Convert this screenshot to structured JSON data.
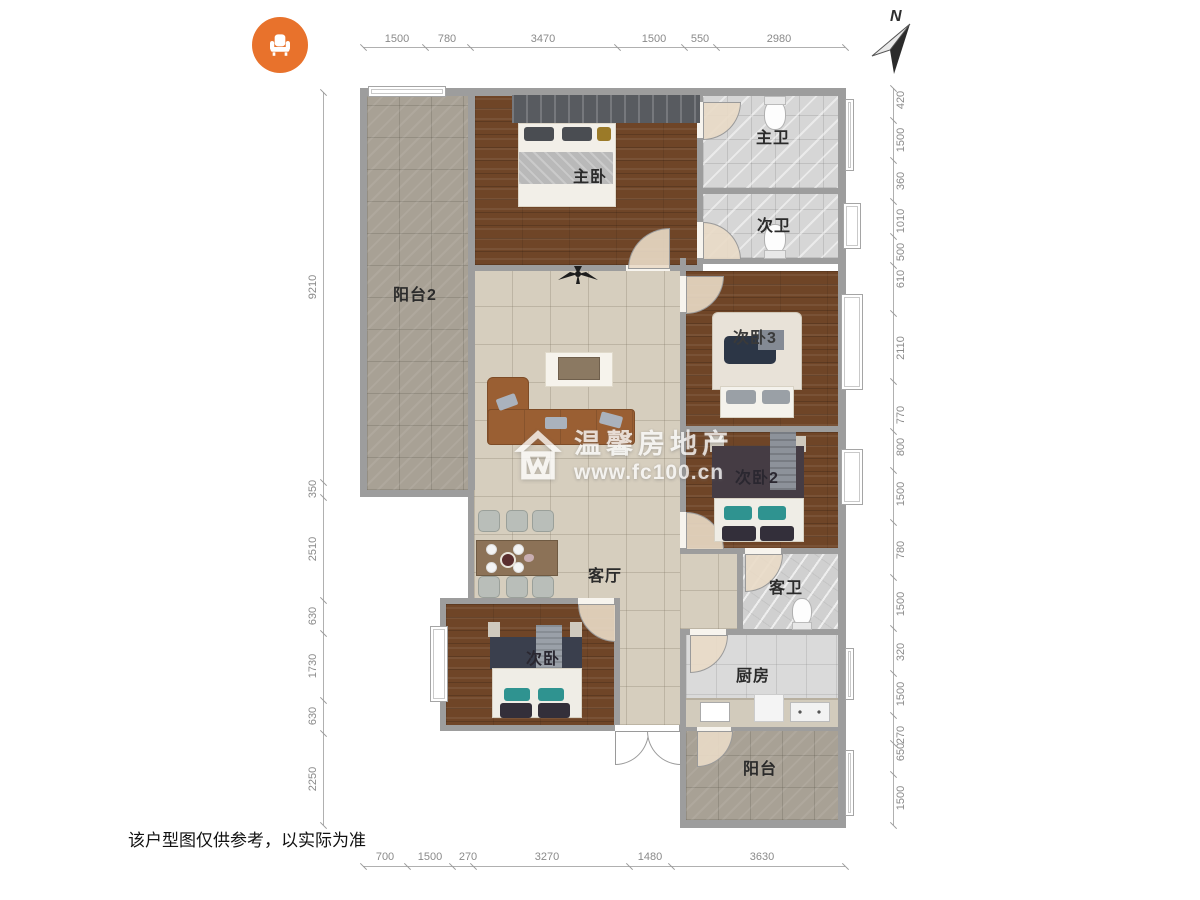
{
  "logo": {
    "icon": "armchair-icon",
    "color": "#e8722c"
  },
  "compass": {
    "label": "N"
  },
  "watermark": {
    "brand": "温馨房地产",
    "url": "www.fc100.cn"
  },
  "disclaimer": "该户型图仅供参考，以实际为准",
  "rooms": {
    "balcony2": "阳台2",
    "master_bedroom": "主卧",
    "master_bath": "主卫",
    "second_bath": "次卫",
    "bedroom3": "次卧3",
    "bedroom2": "次卧2",
    "living": "客厅",
    "guest_bath": "客卫",
    "kitchen": "厨房",
    "bedroom": "次卧",
    "balcony": "阳台"
  },
  "dimensions": {
    "top": [
      "1500",
      "780",
      "3470",
      "1500",
      "550",
      "2980"
    ],
    "bottom": [
      "700",
      "1500",
      "270",
      "3270",
      "1480",
      "3630"
    ],
    "left": [
      "9210",
      "350",
      "2510",
      "630",
      "1730",
      "630",
      "2250"
    ],
    "right": [
      "420",
      "1500",
      "360",
      "1010",
      "500",
      "610",
      "2110",
      "770",
      "800",
      "1500",
      "780",
      "1500",
      "320",
      "1500",
      "270",
      "650",
      "1500"
    ]
  },
  "colors": {
    "accent_orange": "#e8722c",
    "wall_gray": "#9d9d9d",
    "wood_floor": "#6f4527",
    "living_tile": "#d6cebe",
    "balcony_floor": "#a8a195",
    "teal_pillow": "#2f9390"
  }
}
